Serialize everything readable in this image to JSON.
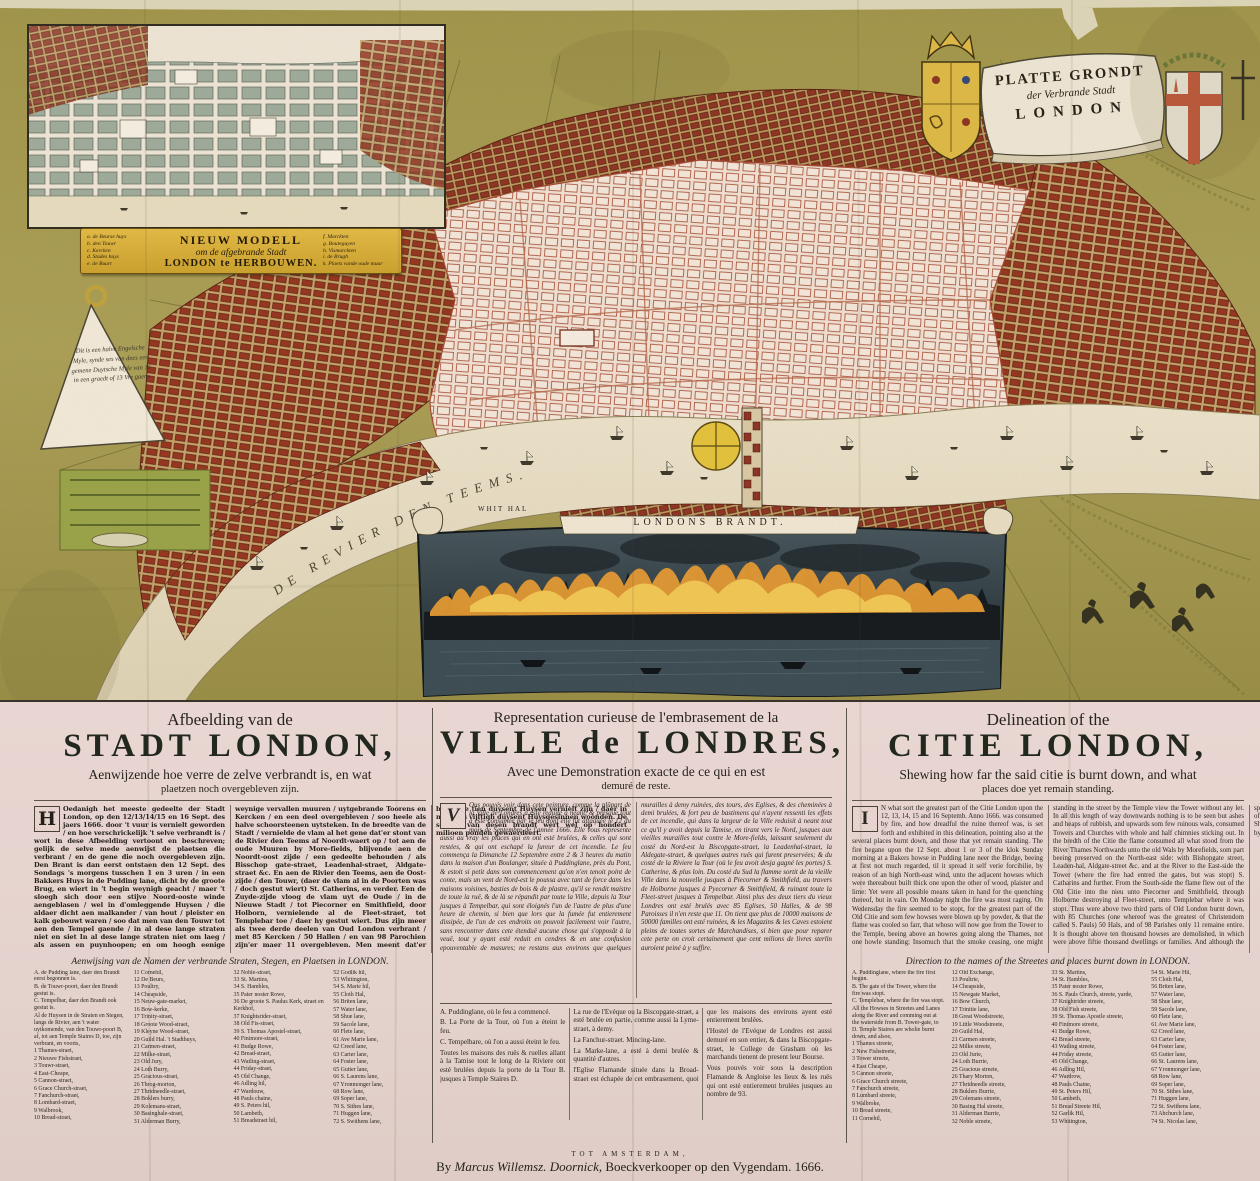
{
  "map": {
    "river_label": "DE  REVIER  DEN  TEEMS.",
    "whitehall_label": "WHIT HAL",
    "fire_caption": "LONDONS  BRANDT.",
    "scale_lines": [
      "Dit is een halve Engelsche",
      "Myle, synde ses van dees een",
      "gemene Duytsche Myle van 15",
      "in een graedt of 13 Vre gaens"
    ],
    "colors": {
      "field_olive": "#a89c52",
      "burnt_area": "#f0e0d2",
      "burnt_outline": "#a64b33",
      "unburnt_blocks": "#96351f",
      "river": "#e6dcc3",
      "banner_gold": "#d8ae3e",
      "panel_pink": "#e9d6d2"
    }
  },
  "title_banner": {
    "line1": "PLATTE GRONDT",
    "line2": "der Verbrande Stadt",
    "line3": "LONDON"
  },
  "inset": {
    "title_line1": "NIEUW  MODELL",
    "title_line2": "om de afgebrande Stadt",
    "title_line3": "LONDON te HERBOUWEN.",
    "legend_left": [
      "a. de Beurse huys",
      "b. den Touwr",
      "c. Kercken",
      "d. Stades huys",
      "e. de Buurt"
    ],
    "legend_right": [
      "f. Marckten",
      "g. Bouteguyen",
      "h. Vismarckten",
      "i. de Brugh",
      "k. Plaets vande oude muur"
    ]
  },
  "sections": {
    "dutch": {
      "kicker": "Afbeelding van de",
      "title": "STADT LONDON,",
      "subtitle": "Aenwijzende hoe verre de zelve verbrandt is, en wat",
      "subtitle2": "plaetzen noch overgebleven zijn.",
      "dropcap": "H",
      "body_col1": "Oedanigh het meeste gedeelte der Stadt London, op den 12/13/14/15 en 16 Sept. des jaers 1666. door 't vuur is vernielt geworden / en hoe verschrickelijk 't selve verbrandt is / wort in dese Afbeelding vertoont en beschreven; gelijk de selve mede aenwijst de plaetsen die verbrant / en de gene die noch overgebleven zijn. Den Brant is dan eerst ontstaen den 12 Sept. des Sondags 's morgens tusschen 1 en 3 uren / in een Bakkers Huys in de Pudding lane, dicht by de groote Brug, en wiert in 't begin weynigh geacht / maer 't sloegh sich door een stijve Noord-ooste winde aengeblasen / wel in d'omleggende Huysen / die aldaer dicht aen malkander / van hout / pleister en kalk gebouwt waren / soo dat men van den Touwr tot aen den Tempel gaende / in al dese lange straten niet en siet",
      "body_col2": "In al dese lange straten niet om laeg / als assen en puynhoopen; en om hoogh eenige weynige vervallen muuren / uytgebrande Toorens en Kercken / en een deel overgebleven / soo heele als halve schoorsteenen uytsteken. In de breedte van de Stadt / vernielde de vlam al het gene dat'er stont van de Rivier den Teems af Noordt-waert op / tot aen de oude Muuren by More-fields, blijvende aen de Noordt-oost zijde / een gedeelte behouden / als Bisschop gate-straet, Leadenhal-straet, Aldgate-straet &c. En aen de Rivier den Teems, aen de Oost-zijde / den Touwr, (daer de vlam al in de Poorten was / doch gestut wiert) St. Catherins, en verder. Een de Zuyde-zijde vloog de vlam uyt de Oude / in de Nieuwe Stadt / tot Piecorner en Smithfield, door Holborn, vernielende al de Fleet-straet, tot Templebar toe / daer hy gestut wiert. Dus zijn meer als twee derde deelen van Oud London verbrant / met 85 Kercken / 50 Hallen / en van 98 Parochien zijn'er maer 11 overgebleven. Men meent dat'er boven de tien duysent Huysen vernielt zijn / daer in meer als vijftigh duysent Huysgesinnen woonden. De schade van desen brandt wert wel op hondert milioen ponden gewaerdeert.",
      "list_heading": "Aenwijsing van de Namen der verbrande Straten, Stegen, en Plaetsen in LONDON.",
      "streets": [
        "A. de Pudding lane, daer den Brandt eerst begonnen is.",
        "B. de Touwr-poort, daer den Brandt gestut is.",
        "C. Tempelbar, daer den Brandt ook gestut is.",
        "Al de Huysen in de Straten en Stegen, langs de Rivier, aen 't water uytkomende, van den Touwr-poort B, af, tot aen Temple Staires D, toe, zijn verbrant, en voorts,",
        "1 Thames-straet,",
        "2 Nieuwe Fishstraet,",
        "3 Touwr-straet,",
        "4 East-Cheape,",
        "5 Cannon-straet,",
        "6 Grace Church-straet,",
        "7 Fanchurch-straet,",
        "8 Lombard-straet,",
        "9 Walbrook,",
        "10 Bread-straet,",
        "11 Cornehil,",
        "12 De Beurs,",
        "13 Poultry,",
        "14 Cheapside,",
        "15 Neuw-gate-market,",
        "16 Bow-kerke,",
        "17 Trinity-straet,",
        "18 Groote Wood-straet,",
        "19 Kleyne Wood-straet,",
        "20 Guild Hal. 't Stadthuys,",
        "21 Carmen-straet,",
        "22 Milke-straet,",
        "23 Old Jury,",
        "24 Loth Burry,",
        "25 Gracious-straet,",
        "26 Throg-morton,",
        "27 Thridneedle-straet,",
        "28 Boklers burry,",
        "29 Kolemans-straet,",
        "30 Basinghale-straet,",
        "31 Alderman Burry,",
        "32 Noble-straet,",
        "33 St. Martins,",
        "34 S. Hambles,",
        "35 Pater noster Rowe,",
        "36 De groote S. Paulus Kerk, straet en Kerkhof,",
        "37 Knightsrider-straet,",
        "38 Old Fis-straet,",
        "39 S. Thomas Apostel-straet,",
        "40 Finimore-straet,",
        "41 Budge Rowe,",
        "42 Bread-straet,",
        "43 Watling-straet,",
        "44 Friday-straet,",
        "45 Old Change,",
        "46 Adling hil,",
        "47 Wardouw,",
        "48 Pauls chaine,",
        "49 S. Peters hil,",
        "50 Lambeth,",
        "51 Breadstraet hil,",
        "52 Godlik hil,",
        "53 Whitington,",
        "54 S. Marie hil,",
        "55 Cloth Hal,",
        "56 Briten lane,",
        "57 Water lane,",
        "58 Shue lane,",
        "59 Sacole lane,",
        "60 Flete lane,",
        "61 Ave Marie lane,",
        "62 Creed lane,",
        "63 Carter lane,",
        "64 Foster lane,",
        "65 Gutter lane,",
        "66 S. Laurens lane,",
        "67 Yronmonger lane,",
        "68 Row lane,",
        "69 Soper lane,",
        "70 S. Sithes lane,",
        "71 Huggen lane,",
        "72 S. Swithens lane,",
        "73 Abchurch lane,",
        "74 S. Nicolas lane,",
        "75 S. Clemens lane,",
        "76 Bechen lane,",
        "77 S. Michiels lane,",
        "78 S. Martins lane,",
        "79 S. Laurence lane,",
        "80 Bush lane,",
        "81 Philpot lane,",
        "82 Rood lane,",
        "83 Louer lane,",
        "84 Botulph lane,",
        "85 Water lane,",
        "86 Beare lane,",
        "87 Touwr dock, &c.",
        "88 Bisschopgate-straet, ten deele verbrant,",
        "89 Lyme-straet, half verbrant,",
        "90 Fanchurch-straet, half verbrant,",
        "91 Mincing lane, ten deele verbrant,",
        "92 Marke lane, ten deele verbrant,",
        "93 Seathing lane, ten deele verbrant."
      ]
    },
    "french": {
      "kicker": "Representation curieuse de l'embrasement de la",
      "title": "VILLE de LONDRES,",
      "subtitle": "Avec une Demonstration exacte de ce qui en est",
      "subtitle2": "demuré de reste.",
      "dropcap": "V",
      "body_col1": "Ous pouvés voir dans cete peinture, comme la plûpart de la Ville de Londres a esté reduite à neant, & presque tout a esté consumée par le feu dont elle fut attaquée le 12 du mois de Septembre de l'année 1666. Elle vous represente aussi au vray les places qui en ont esté brulées, & celles qui sont restées, & qui ont eschapé la fureur de cet incendie. Le feu commença la Dimanche 12 Septembre entre 2 & 3 heures du matin dans la maison d'un Boulanger, située à Puddinglane, près du Pont, & estoit si petit dans son commencement qu'on n'en tenoit point de conte, mais un vent de Nord-est le poussa avec tant de force dans les maisons voisines, basties de bois & de plastre, qu'il se rendit maistre de toute la ruë, & de là se répandit par toute la Ville, depuis la Tour jusques à Tempelbar, qui sont éloignés l'un de l'autre de plus d'une heure de chemin, si bien que lors que la fumée fut entierement dissipée, de l'un de ces endroits on pouvoit facilement voir l'autre, sans",
      "body_col2": "rencontrer dans cete étenduë aucune chose qui s'opposât à la veuë, tout y ayant esté reduit en cendres & en une confusion epouventable de masures; ne restans aux environs que quelques murailles à demy ruinées, des tours, des Eglises, & des cheminées à demi brulées, & fort peu de bastimens qui n'ayent ressenti les effets de cet incendie, qui dans la largeur de la Ville reduisit à neant tout ce qu'il y avoit depuis la Tamise, en tirant vers le Nord, jusques aux vieilles murailles tout contre le More-fields, laissant seulement du costé du Nord-est la Biscopgate-straet, la Leadenhal-straet, la Aldegate-straet, & quelques autres ruës qui furent preservées; & du costé de la Riviere la Tour (où le feu avoit desja gagné les portes) S. Catherine, & plus loin. Du costé du Sud la flamme sortit de la vieille Ville dans la nouvelle jusques à Piecorner & Smithfield, au travers de Holborne jusques à Pyecorner & Smithfield, & ruinant toute la Fleet-street jusques à Tempelbar. Ainsi plus des deux tiers du vieux Londres ont esté brulés avec 85 Eglises, 50 Halles, & de 98 Paroisses il n'en reste que 11. On tient que plus de 10000 maisons de 50000 familles ont esté ruinées, & les Magazins & les Caves estoient pleins de toutes sortes de Marchandises, si bien que pour reparer cete perte on croit certainement que cent milions de livres sterlin auroient peiné à y suffire.",
      "notes": [
        "A. Puddinglane, où le feu a commencé.",
        "B. La Porte de la Tour, où l'on a éteint le feu.",
        "C. Tempelbare, où l'on a aussi éteint le feu.",
        "Toutes les maisons des ruës & ruelles allant à la Tamise tout le long de la Riviere ont esté brulées depuis la porte de la Tour B. jusques à Temple Staires D.",
        "La rue de l'Evéque ou la Biscopgate-straet, a esté brulée en partie, comme aussi la Lyme-straet, à demy.",
        "La Fanchur-straet. Mincing-lane.",
        "La Marke-lane, a esté à demi brulée & quantité d'autres.",
        "l'Eglise Flamande située dans la Broad-straet est échapée de cet embrasement, quoi que les maisons des environs ayent esté entierement brulées.",
        "l'Hostel de l'Evéque de Londres est aussi demuré en son entier, & dans la Biscopgate-straet, le College de Grasham où les marchands tienent de present leur Bourse.",
        "Vous pouvés voir sous la description Flamande & Angloise les lieux & les ruës qui ont esté entierement brulées jusques au nombre de 93."
      ]
    },
    "english": {
      "kicker": "Delineation of the",
      "title": "CITIE LONDON,",
      "subtitle": "Shewing how far the said citie is burnt down, and what",
      "subtitle2": "places doe yet remain standing.",
      "dropcap": "I",
      "body_col1": "N what sort the greatest part of the Citie London upon the 12, 13, 14, 15 and 16 Septemb. Anno 1666. was consumed by fire, and how dreadful the ruine thereof was, is set forth and exhibited in this delineation, pointing also at the several places burnt down, and those that yet remain standing. The fire begane upon the 12 Sept. about 1 or 3 of the klok Sunday morning at a Bakers howse in Pudding lane neer the Bridge, beeing at first not much regarded, til it spread it self verie forcibilie, by reason of an high North-east wind, unto the adjacent howses which were thereabout built thick one upon the other of wood, plaister and lime: Yet were all possible means taken in hand for the quenching thereof, but in vain. On Monday night the fire was most raging. On Wedensday the fire seemed to be stopt, for the greatest part of the Old Citie and som few howses were blown up by powder, & that the flame was cooled so farr, that whoso will now goe from the Tower to the Temple, beeing above an howres going along the Thames, not one howle standing; Insomuch that the smoke ceasing, one might standing in the street by the Temple view the Tower without any let. In all",
      "body_col2": "this length of way downwards nothing is to be seen but ashes and heaps of rubbish, and upwards som few ruinous wals, consumed Towers and Churches with whole and half chimnies sticking out. In the bredth of the Citie the flame consumed all what stood from the River Thames Northwards unto the old Wals by Morefields, som part beeing preserved on the North-east side: with Bishopgate street, Leaden-hal, Aldgate-street &c. and at the River to the East-side the Tower (where the fire had entred the gates, but was stopt) S. Catharins and further. From the South-side the flame flew out of the Old Citie into the nieu unto Piecorner and Smithfield, through Holborne destroying al Fleet-street, unto Templebar where it was stopt. Thus were above two third parts of Old London burnt down, with 85 Churches (one whereof was the greatest of Christendom called S. Pauls) 50 Hals, and of 98 Parishes only 11 remaine entire. It is thought above ten thousand howses are demolished, in which were above fiftie thousand dwellings or families. And although the space burnt down seemeth not to be verie great in this map, yet is it of that space, which had in it the most part of Merchants, richest Shops, ware howses and Cellars ful of Merchandise. The dammage by this fire is judged to amount to an 100 millions of pounds.",
      "list_heading": "Direction to the names of the Streetes and places burnt down in LONDON.",
      "streets": [
        "A. Puddinglane, where the fire first begun.",
        "B. The gate of the Tower, where the fire was stopt.",
        "C. Templebar, where the fire was stopt.",
        "All the Howses in Streetes and Lanes along the River and comming out at the waterside from B. Tower-gate, to D. Temple Staires are wholie burnt down, and alsoe,",
        "1 Thames streete,",
        "2 New Fishstreete,",
        "3 Tower streete,",
        "4 East Cheape,",
        "5 Cannon streete,",
        "6 Grace Church streete,",
        "7 Fanchurch streete,",
        "8 Lumbard streete,",
        "9 Walbroke,",
        "10 Bread streete,",
        "11 Cornehil,",
        "12 Old Exchange,",
        "13 Poultrie,",
        "14 Cheapside,",
        "15 Newgate Market,",
        "16 Bow Church,",
        "17 Trinitie lane,",
        "18 Great Woodstreete,",
        "19 Little Woodstreete,",
        "20 Guild Hal,",
        "21 Carmen streete,",
        "22 Milke streete,",
        "23 Old Jurie,",
        "24 Loth Burrie,",
        "25 Gracious streete,",
        "26 Thary Morton,",
        "27 Thridneedle streete,",
        "28 Buklers Burrie,",
        "29 Colemans streete,",
        "30 Basing Hal streete,",
        "31 Alderman Burrie,",
        "32 Noble streete,",
        "33 St. Martins,",
        "34 St. Hambles,",
        "35 Pater noster Rowe,",
        "36 S. Pauls Church, streete, yarde,",
        "37 Knightrider streete,",
        "38 Old Fish streete,",
        "39 St. Thomas Apostle streete,",
        "40 Finimore streete,",
        "41 Budge Rowe,",
        "42 Bread streete,",
        "43 Watling streete,",
        "44 Friday streete,",
        "45 Old Change,",
        "46 Adling Hil,",
        "47 Wardrow,",
        "48 Pauls Chaine,",
        "49 St. Peters Hil,",
        "50 Lambeth,",
        "51 Bread Streete Hil,",
        "52 Garlik Hil,",
        "53 Whitington,",
        "54 St. Marie Hil,",
        "55 Cloth Hal,",
        "56 Briten lane,",
        "57 Water lane,",
        "58 Shue lane,",
        "59 Sacole lane,",
        "60 Flete lane,",
        "61 Ave Marie lane,",
        "62 Creed lane,",
        "63 Carter lane,",
        "64 Foster lane,",
        "65 Gutter lane,",
        "66 St. Laurens lane,",
        "67 Yronmonger lane,",
        "68 Row lane,",
        "69 Soper lane,",
        "70 St. Sithes lane,",
        "71 Huggen lane,",
        "72 St. Swithens lane,",
        "73 Abchurch lane,",
        "74 St. Nicolas lane,",
        "75 St. Clemens lane,",
        "76 Birchen lane,",
        "77 St. Michaels lane,",
        "78 St. Martins lane,",
        "79 St. Laurence lane,",
        "80 Bush lane,",
        "81 Philpot lane,",
        "82 Rood lane,",
        "83 Lovat lane,",
        "84 Botulph lane,",
        "85 Water lane,",
        "86 Beare lane,",
        "87 Tower dock, &c.",
        "88 Bishopgate-street, partly burnt,",
        "89 Lyme street, half burnt,",
        "90 Fanchurch street, half burnt,",
        "91 Mincing lane, partly burnt,",
        "92 Marke lane, partly burnt,",
        "93 Seathing lane, partly burnt.",
        "The Dutch Church in Broadstreet, remaines standing (although the howses round about it were burned down) and also the Bishop of Londons howse, and Grasham Colledge in Bishopgatestreet, where now merchants keep their Exchange meetings."
      ]
    }
  },
  "imprint": {
    "line1": "TOT  AMSTERDAM,",
    "line2_prefix": "By ",
    "line2_name": "Marcus Willemsz. Doornick,",
    "line2_suffix": " Boeckverkooper op den Vygendam. 1666."
  }
}
